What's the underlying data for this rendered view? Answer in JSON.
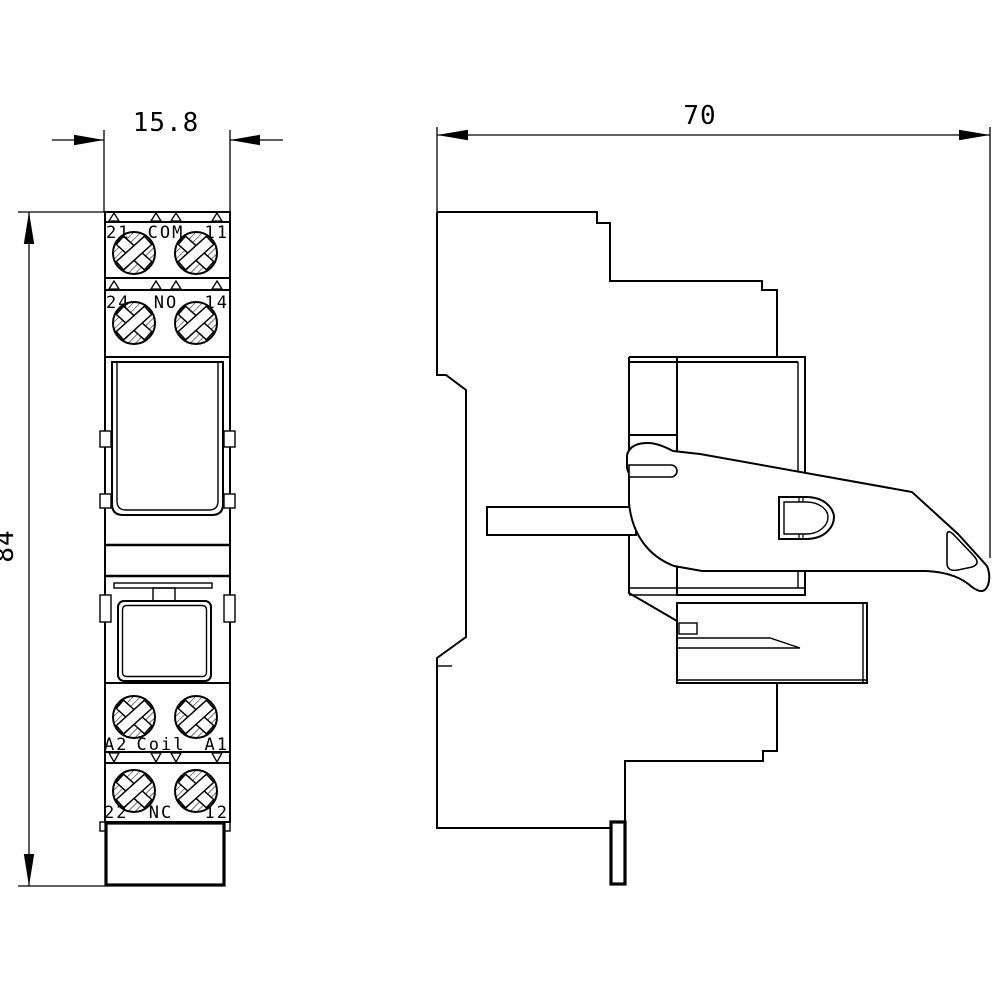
{
  "drawing": {
    "type": "technical-dimension-drawing",
    "views": [
      "front-view",
      "side-view"
    ],
    "colors": {
      "line": "#000000",
      "background": "#ffffff"
    }
  },
  "dimensions": {
    "front_width": "15.8",
    "front_height": "84",
    "side_depth": "70"
  },
  "terminal_labels": {
    "row1": {
      "left": "21",
      "center": "COM",
      "right": "11"
    },
    "row2": {
      "left": "24",
      "center": "NO",
      "right": "14"
    },
    "row3": {
      "left": "A2",
      "center": "Coil",
      "right": "A1"
    },
    "row4": {
      "left": "22",
      "center": "NC",
      "right": "12"
    }
  }
}
